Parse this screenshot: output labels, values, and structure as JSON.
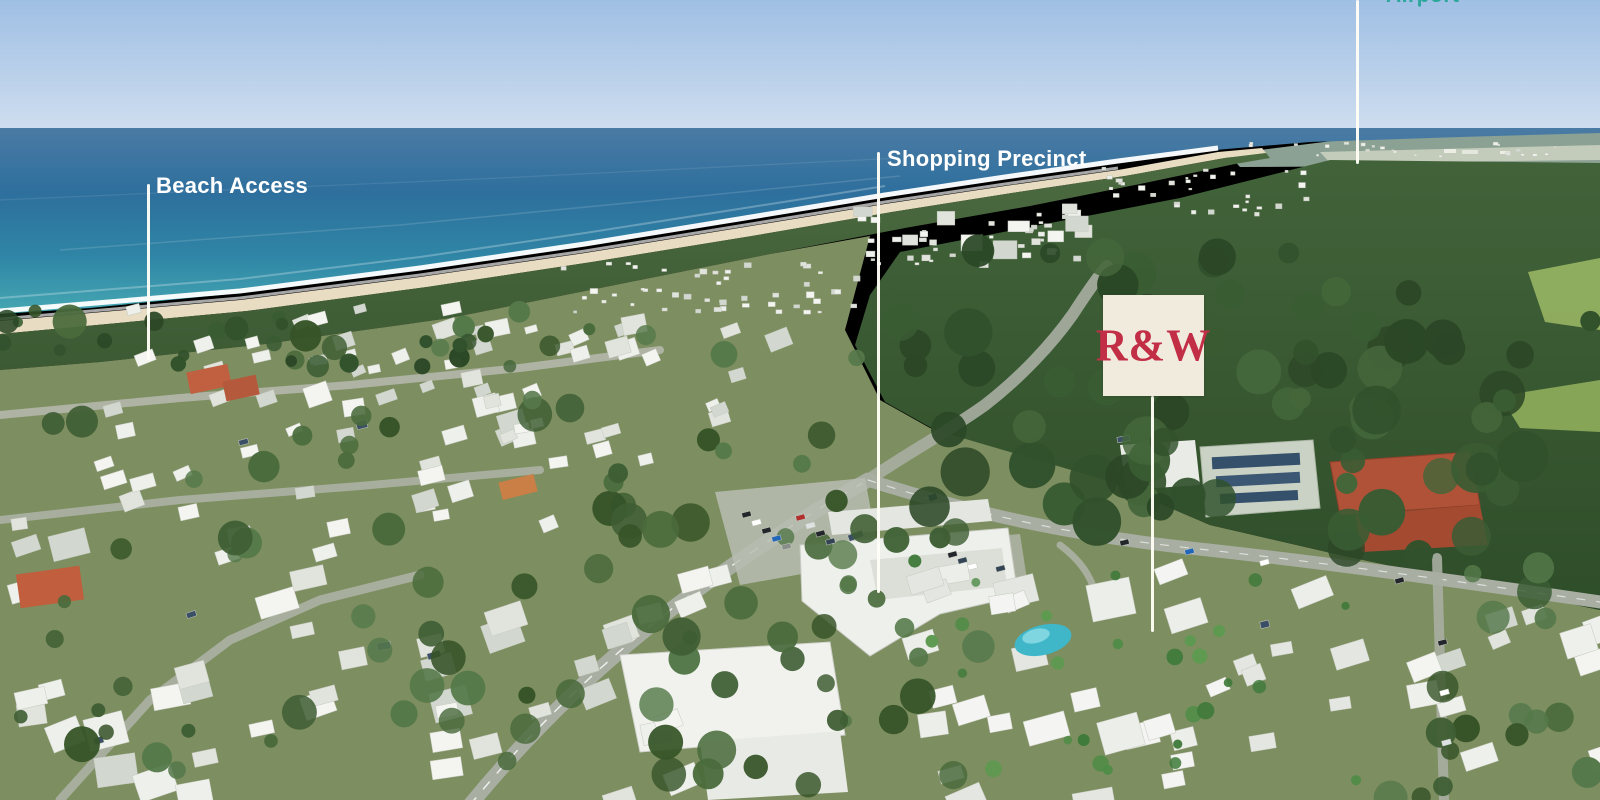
{
  "scene_type": "aerial-coastal-photograph",
  "annotations": {
    "beach_access": {
      "label": "Beach Access"
    },
    "shopping_precinct": {
      "label": "Shopping Precinct"
    },
    "brand_logo": {
      "text": "R&W",
      "background": "#f0ebdd",
      "color": "#c22e46"
    },
    "top_right_partial": {
      "label": "Airport",
      "color": "#2ba79b",
      "cropped": true
    }
  },
  "colors": {
    "sky_top": "#9fbfe4",
    "sky_horizon": "#cdddef",
    "ocean_deep": "#37719f",
    "ocean_shallow": "#44a5b1",
    "surf": "#ffffff",
    "sand": "#e8dcc2",
    "dune_vegetation": "#46653c",
    "forest": "#39572f",
    "suburb_ground": "#7d8e60",
    "roof_white": "#f2f4f1",
    "roof_terracotta": "#b05238",
    "road": "#a8aea2",
    "pool": "#3fb7c9",
    "pointer_line": "#fffef6",
    "label_text": "#ffffff"
  }
}
